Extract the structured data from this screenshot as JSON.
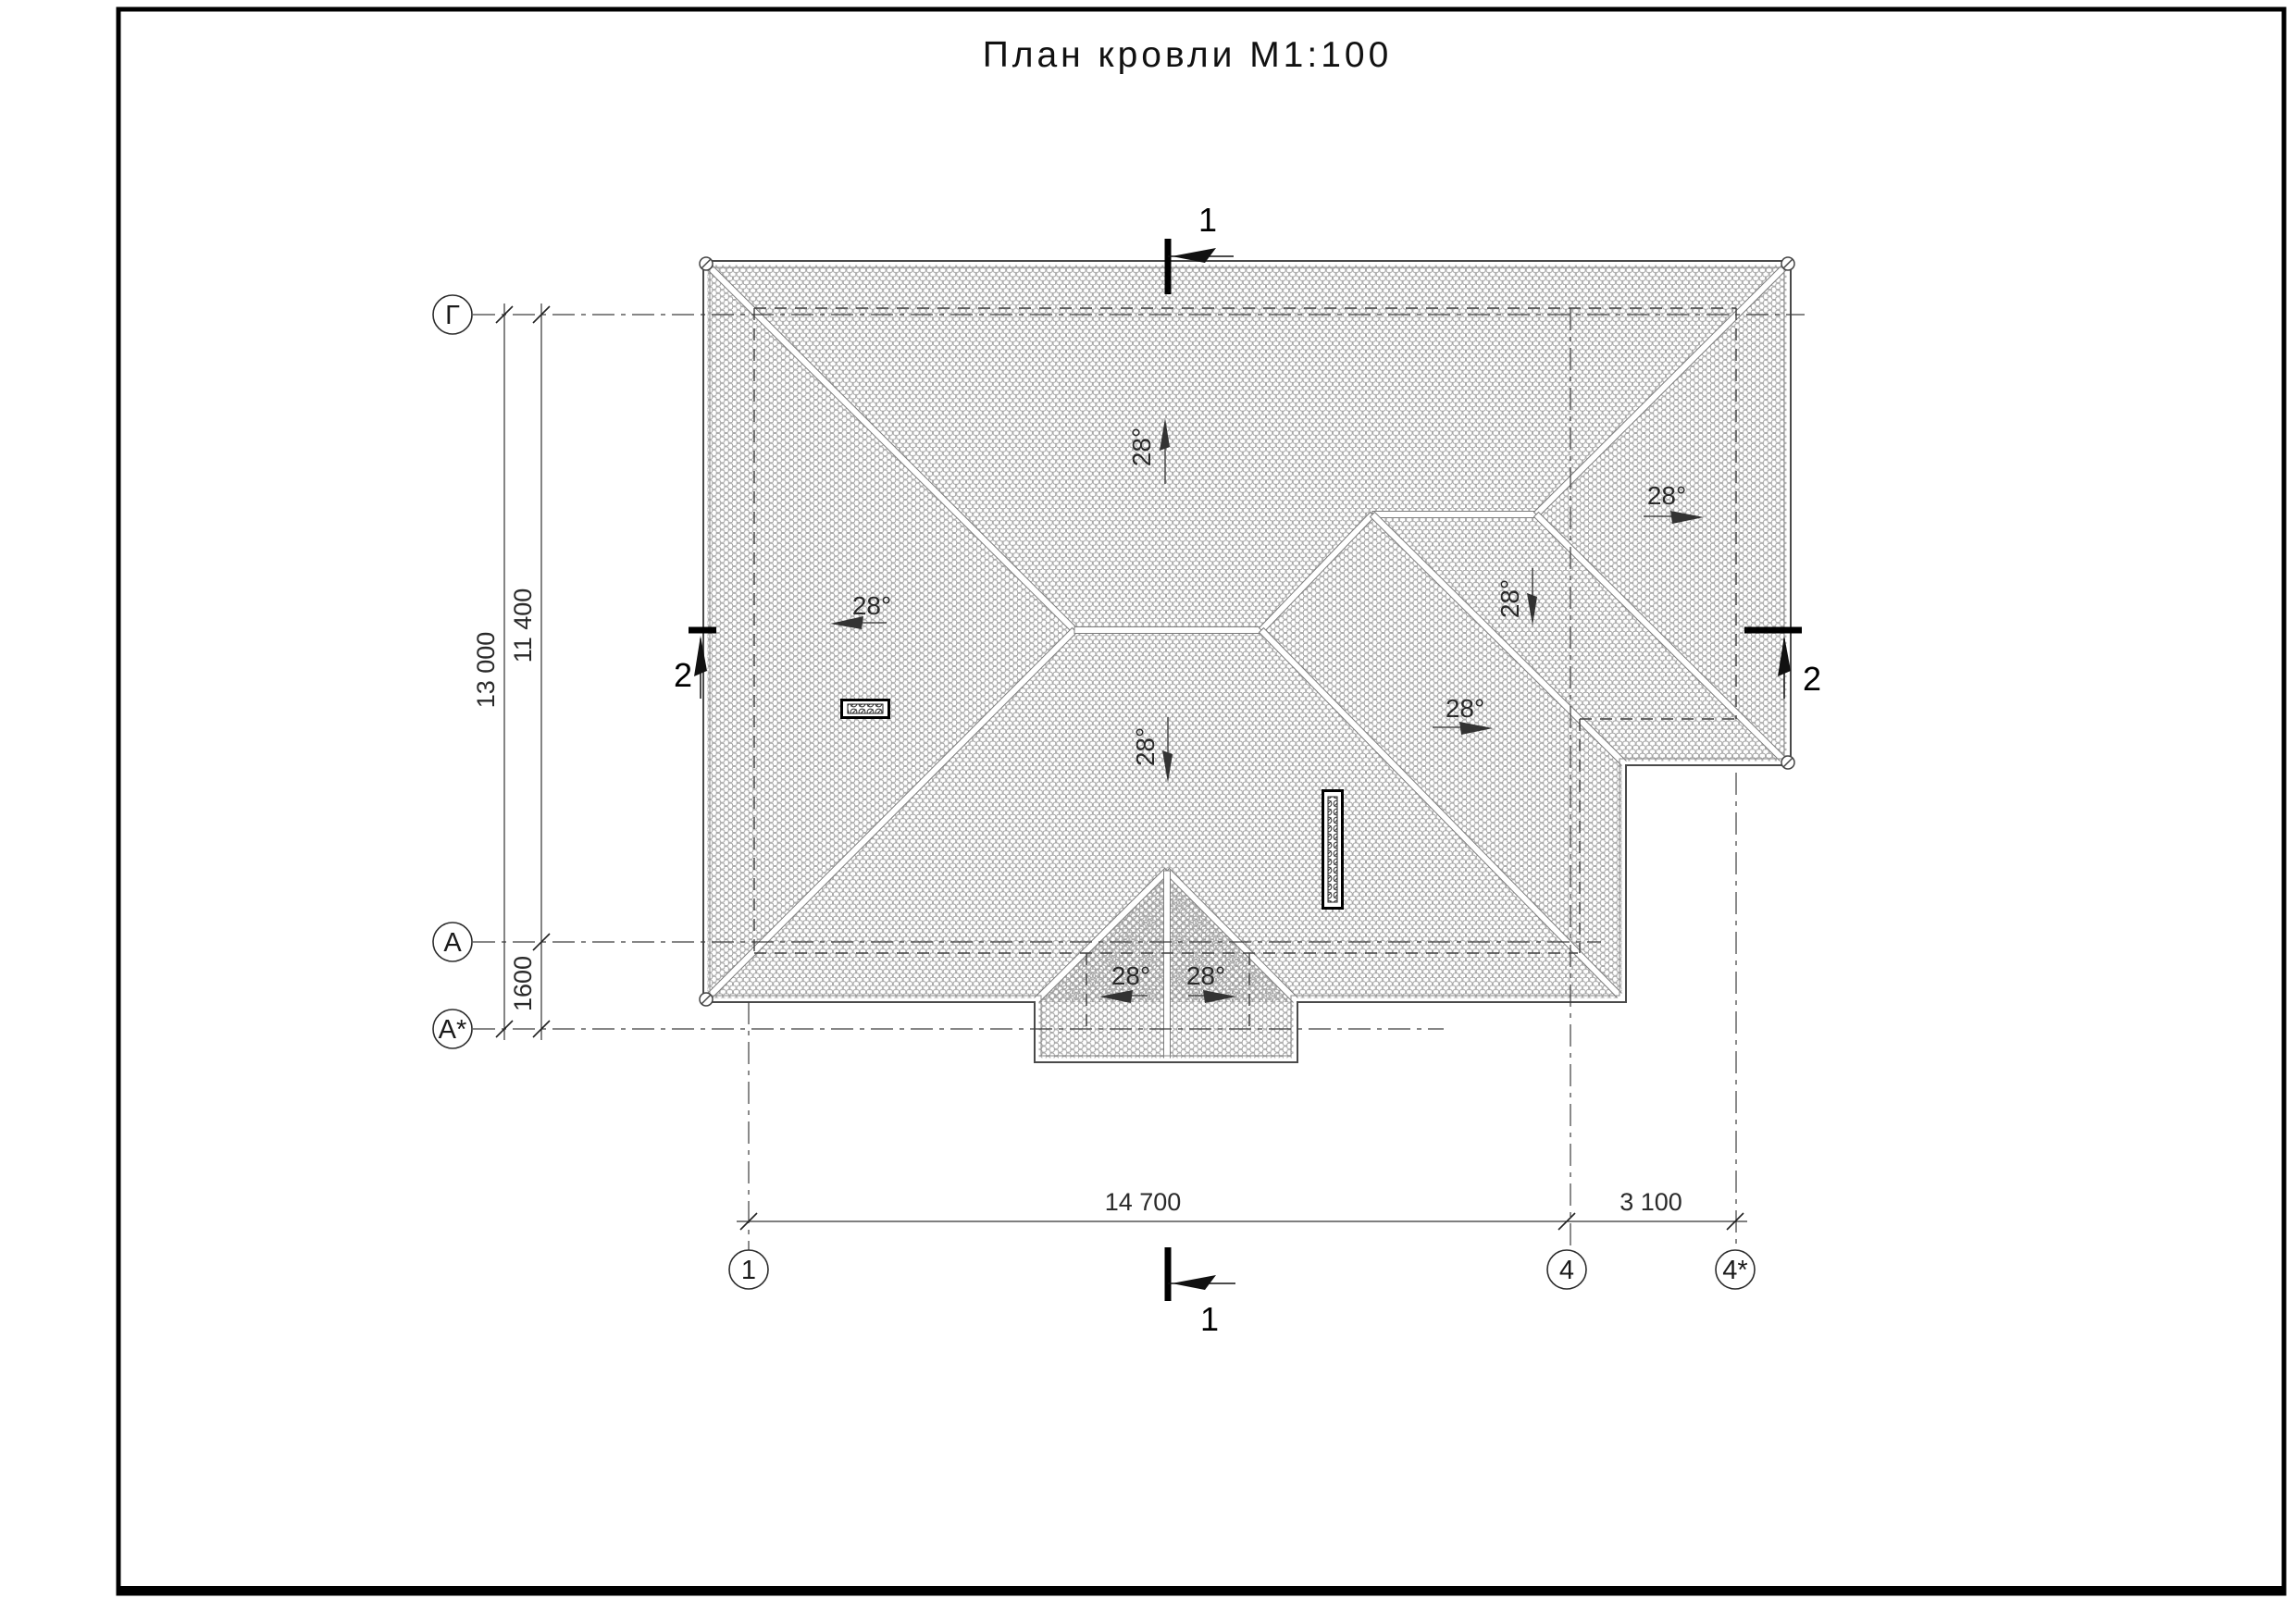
{
  "title": "План кровли М1:100",
  "grid_axes": {
    "left": [
      {
        "label": "Г"
      },
      {
        "label": "А"
      },
      {
        "label": "А*"
      }
    ],
    "bottom": [
      {
        "label": "1"
      },
      {
        "label": "4"
      },
      {
        "label": "4*"
      }
    ]
  },
  "dimensions": {
    "overall_height": "13 000",
    "inner_height": "11 400",
    "porch_offset": "1600",
    "main_width": "14 700",
    "extension_width": "3 100"
  },
  "slopes": [
    {
      "id": "north",
      "label": "28°",
      "direction": "up"
    },
    {
      "id": "west",
      "label": "28°",
      "direction": "left"
    },
    {
      "id": "south-main",
      "label": "28°",
      "direction": "down"
    },
    {
      "id": "east-middle",
      "label": "28°",
      "direction": "right"
    },
    {
      "id": "south-right",
      "label": "28°",
      "direction": "down"
    },
    {
      "id": "east-right",
      "label": "28°",
      "direction": "right"
    },
    {
      "id": "porch-left",
      "label": "28°",
      "direction": "left"
    },
    {
      "id": "porch-right",
      "label": "28°",
      "direction": "right"
    }
  ],
  "sections": {
    "section1": "1",
    "section2": "2"
  },
  "colors": {
    "line": "#3d3d3d",
    "hatch": "#9b9b9b",
    "black": "#000000"
  }
}
